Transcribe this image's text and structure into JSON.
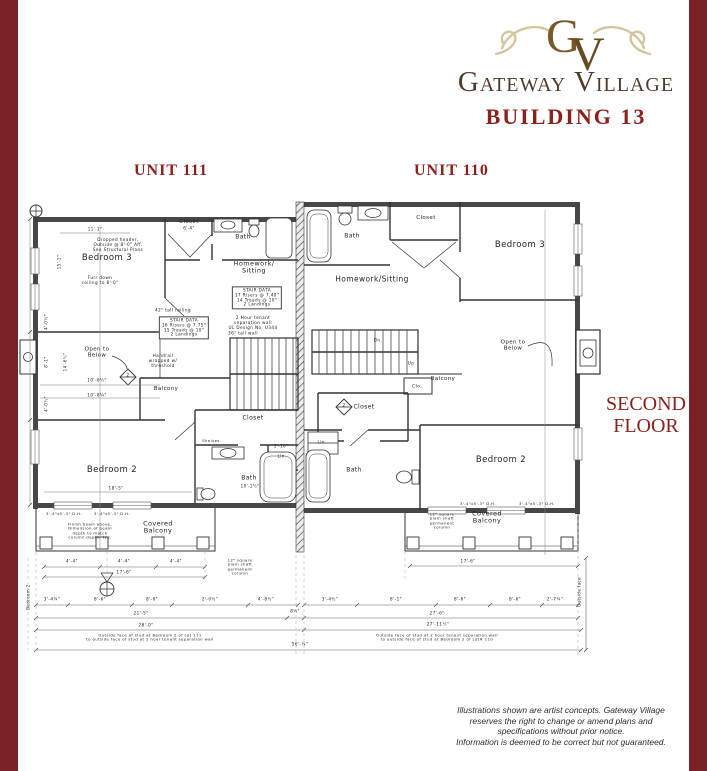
{
  "header": {
    "monogram": "GV",
    "brand": "Gateway Village",
    "building": "BUILDING 13"
  },
  "units": {
    "left": "UNIT 111",
    "right": "UNIT 110"
  },
  "floor": "SECOND FLOOR",
  "disclaimer": "Illustrations shown are artist concepts.  Gateway Village\nreserves the right to change or amend plans and\nspecifications without prior notice.\nInformation is deemed to be correct but not guaranteed.",
  "colors": {
    "maroon_border": "#7a2128",
    "brick_red": "#8d201d",
    "brand_brown": "#4e3b2b",
    "monogram_gold": "#77592c",
    "flourish_tan": "#d3c69c",
    "ink": "#333333"
  },
  "plan_labels": [
    {
      "n": "bedroom3-left-label",
      "t": "Bedroom 3",
      "x": 107,
      "y": 259,
      "fs": 8.5
    },
    {
      "n": "dropped-header-note",
      "t": "Dropped header,\nOutside @ 8'-0\" Aff.\nSee Structural Plans",
      "x": 118,
      "y": 245,
      "fs": 4.2
    },
    {
      "n": "furr-down-note",
      "t": "Furr down\nceiling to 8'-0\"",
      "x": 100,
      "y": 281,
      "fs": 4.2
    },
    {
      "n": "closet-left-top-label",
      "t": "Closet",
      "x": 189,
      "y": 222,
      "fs": 5.5
    },
    {
      "n": "closet-left-top-dim",
      "t": "6'-4\"",
      "x": 189,
      "y": 229,
      "fs": 4
    },
    {
      "n": "bath-left-top-label",
      "t": "Bath",
      "x": 243,
      "y": 238,
      "fs": 6
    },
    {
      "n": "homework-left-label",
      "t": "Homework/\nSitting",
      "x": 254,
      "y": 268,
      "fs": 6.5
    },
    {
      "n": "stair-data-left-1",
      "t": "STAIR DATA\n17 Risers @ 7.40\"\n14 Treads @ 10\"\n2 Landings",
      "x": 257,
      "y": 298,
      "fs": 4.2,
      "b": true
    },
    {
      "n": "tenant-wall-note-left",
      "t": "2 Hour tenant\nseparation wall\nUL Design No. U344",
      "x": 253,
      "y": 323,
      "fs": 4.2
    },
    {
      "n": "wall-36-note",
      "t": "36\" tall wall",
      "x": 243,
      "y": 334,
      "fs": 4.2
    },
    {
      "n": "stair-data-left-2",
      "t": "STAIR DATA\n16 Risers @ 7.75\"\n15 Treads @ 10\"\n2 Landings",
      "x": 184,
      "y": 328,
      "fs": 4.2,
      "b": true
    },
    {
      "n": "railing-42-note",
      "t": "42\" tall railing",
      "x": 173,
      "y": 311,
      "fs": 4.2
    },
    {
      "n": "handrail-note",
      "t": "Handrail\nwrapped w/\nthreshold",
      "x": 163,
      "y": 361,
      "fs": 4.2
    },
    {
      "n": "balcony-left-label",
      "t": "Balcony",
      "x": 166,
      "y": 389,
      "fs": 5.5
    },
    {
      "n": "open-below-left-label",
      "t": "Open to\nBelow",
      "x": 97,
      "y": 353,
      "fs": 5.5
    },
    {
      "n": "dim-10-6",
      "t": "10'-6½\"",
      "x": 97,
      "y": 381,
      "fs": 4.2
    },
    {
      "n": "dim-10-8",
      "t": "10'-8¼\"",
      "x": 97,
      "y": 396,
      "fs": 4.2
    },
    {
      "n": "bedroom2-left-label",
      "t": "Bedroom 2",
      "x": 112,
      "y": 471,
      "fs": 8.5
    },
    {
      "n": "dim-18-5",
      "t": "18'-5\"",
      "x": 116,
      "y": 489,
      "fs": 4.2
    },
    {
      "n": "closet-left-bot-label",
      "t": "Closet",
      "x": 253,
      "y": 419,
      "fs": 6
    },
    {
      "n": "shelves-note",
      "t": "Shelves",
      "x": 211,
      "y": 441,
      "fs": 3.8
    },
    {
      "n": "lin-left-label",
      "t": "Lin.",
      "x": 282,
      "y": 457,
      "fs": 4.2
    },
    {
      "n": "bath-left-bot-label",
      "t": "Bath",
      "x": 249,
      "y": 479,
      "fs": 6
    },
    {
      "n": "dim-10-1",
      "t": "10'-1½\"",
      "x": 250,
      "y": 487,
      "fs": 4
    },
    {
      "n": "dim-5-10",
      "t": "5'-10\"",
      "x": 281,
      "y": 447,
      "fs": 4
    },
    {
      "n": "window-dim-l1",
      "t": "3'-4\"x5'-3\" D.H.",
      "x": 64,
      "y": 514,
      "fs": 3.8
    },
    {
      "n": "window-dim-l2",
      "t": "3'-4\"x5'-3\" D.H.",
      "x": 112,
      "y": 514,
      "fs": 3.8
    },
    {
      "n": "finish-beam-note",
      "t": "Finish beam above.\nDimension of beam\ndepth to match\ncolumn depth, typ.",
      "x": 90,
      "y": 531,
      "fs": 3.8
    },
    {
      "n": "covered-balcony-left-label",
      "t": "Covered\nBalcony",
      "x": 158,
      "y": 528,
      "fs": 6.5
    },
    {
      "n": "column-note-left",
      "t": "12\" square\nplain shaft\npermanent\ncolumn",
      "x": 240,
      "y": 567,
      "fs": 3.8
    },
    {
      "n": "bath-right-top-label",
      "t": "Bath",
      "x": 352,
      "y": 237,
      "fs": 6
    },
    {
      "n": "closet-right-top-label",
      "t": "Closet",
      "x": 426,
      "y": 218,
      "fs": 5.5
    },
    {
      "n": "bedroom3-right-label",
      "t": "Bedroom 3",
      "x": 520,
      "y": 246,
      "fs": 8.5
    },
    {
      "n": "homework-right-label",
      "t": "Homework/Sitting",
      "x": 372,
      "y": 280,
      "fs": 7.5
    },
    {
      "n": "open-below-right-label",
      "t": "Open to\nBelow",
      "x": 513,
      "y": 346,
      "fs": 5.5
    },
    {
      "n": "dn-label",
      "t": "Dn.",
      "x": 378,
      "y": 341,
      "fs": 4.2
    },
    {
      "n": "up-label",
      "t": "Up",
      "x": 411,
      "y": 364,
      "fs": 4.2
    },
    {
      "n": "balcony-right-label",
      "t": "Balcony",
      "x": 443,
      "y": 379,
      "fs": 5.5
    },
    {
      "n": "clo-label",
      "t": "Clo.",
      "x": 417,
      "y": 387,
      "fs": 4.5
    },
    {
      "n": "closet-right-mid-label",
      "t": "Closet",
      "x": 364,
      "y": 408,
      "fs": 6
    },
    {
      "n": "lin-right-label",
      "t": "Lin.",
      "x": 322,
      "y": 443,
      "fs": 4.2
    },
    {
      "n": "bath-right-bot-label",
      "t": "Bath",
      "x": 354,
      "y": 471,
      "fs": 6
    },
    {
      "n": "bedroom2-right-label",
      "t": "Bedroom 2",
      "x": 501,
      "y": 461,
      "fs": 8.5
    },
    {
      "n": "window-dim-r1",
      "t": "3'-4\"x5'-3\" D.H.",
      "x": 478,
      "y": 504,
      "fs": 3.8
    },
    {
      "n": "window-dim-r2",
      "t": "3'-4\"x5'-3\" D.H.",
      "x": 537,
      "y": 504,
      "fs": 3.8
    },
    {
      "n": "covered-balcony-right-label",
      "t": "Covered\nBalcony",
      "x": 487,
      "y": 518,
      "fs": 6.5
    },
    {
      "n": "column-note-right",
      "t": "12\" square\nplain shaft\npermanent\ncolumn",
      "x": 442,
      "y": 521,
      "fs": 3.8
    },
    {
      "n": "dim-4-4-a",
      "t": "4'-4\"",
      "x": 72,
      "y": 562,
      "fs": 4.2
    },
    {
      "n": "dim-4-4-b",
      "t": "4'-4\"",
      "x": 124,
      "y": 562,
      "fs": 4.2
    },
    {
      "n": "dim-4-4-c",
      "t": "4'-4\"",
      "x": 176,
      "y": 562,
      "fs": 4.2
    },
    {
      "n": "dim-17-6-left",
      "t": "17'-6\"",
      "x": 124,
      "y": 573,
      "fs": 4.2
    },
    {
      "n": "dim-17-6-right",
      "t": "17'-6\"",
      "x": 468,
      "y": 562,
      "fs": 4.2
    },
    {
      "n": "dim-3-4q",
      "t": "3'-4¼\"",
      "x": 52,
      "y": 600,
      "fs": 4.2
    },
    {
      "n": "dim-8-6-a",
      "t": "8'-6\"",
      "x": 100,
      "y": 600,
      "fs": 4.2
    },
    {
      "n": "dim-8-6-b",
      "t": "8'-6\"",
      "x": 152,
      "y": 600,
      "fs": 4.2
    },
    {
      "n": "dim-2-0",
      "t": "2'-0½\"",
      "x": 210,
      "y": 600,
      "fs": 4.2
    },
    {
      "n": "dim-4-8",
      "t": "4'-8½\"",
      "x": 266,
      "y": 600,
      "fs": 4.2
    },
    {
      "n": "dim-3-4h",
      "t": "3'-4½\"",
      "x": 330,
      "y": 600,
      "fs": 4.2
    },
    {
      "n": "dim-8-1r",
      "t": "8'-1\"",
      "x": 396,
      "y": 600,
      "fs": 4.2
    },
    {
      "n": "dim-8-6-c",
      "t": "8'-6\"",
      "x": 460,
      "y": 600,
      "fs": 4.2
    },
    {
      "n": "dim-8-6-d",
      "t": "8'-6\"",
      "x": 515,
      "y": 600,
      "fs": 4.2
    },
    {
      "n": "dim-2-7",
      "t": "2'-7¼\"",
      "x": 555,
      "y": 600,
      "fs": 4.2
    },
    {
      "n": "dim-21-5",
      "t": "21'-5\"",
      "x": 141,
      "y": 614,
      "fs": 4.2
    },
    {
      "n": "dim-8h",
      "t": "8½\"",
      "x": 295,
      "y": 612,
      "fs": 4
    },
    {
      "n": "dim-27-6",
      "t": "27'-6\"",
      "x": 437,
      "y": 614,
      "fs": 4.2
    },
    {
      "n": "dim-28-0",
      "t": "28'-0\"",
      "x": 146,
      "y": 626,
      "fs": 4.2
    },
    {
      "n": "dim-27-11",
      "t": "27'-11½\"",
      "x": 438,
      "y": 625,
      "fs": 4.2
    },
    {
      "n": "stud-note-left",
      "t": "Outside face of stud at Bedroom 2 of Lot 111\nto outside face of stud at 2 hour tenant separation wall",
      "x": 150,
      "y": 638,
      "fs": 3.8
    },
    {
      "n": "stud-note-right",
      "t": "Outside face of stud at 2 hour tenant separation wall\nto outside face of stud at Bedroom 2 of Lot# 110",
      "x": 437,
      "y": 638,
      "fs": 3.8
    },
    {
      "n": "dim-56",
      "t": "56'-¼\"",
      "x": 300,
      "y": 645,
      "fs": 4.2
    },
    {
      "n": "outside-face-label",
      "t": "Outside face",
      "x": 580,
      "y": 592,
      "fs": 4,
      "r": -90
    },
    {
      "n": "bedroom2-vert-label",
      "t": "Bedroom 2",
      "x": 29,
      "y": 597,
      "fs": 4,
      "r": -90
    },
    {
      "n": "dim-15-2",
      "t": "15'-2\"",
      "x": 60,
      "y": 262,
      "fs": 4,
      "r": -90
    },
    {
      "n": "dim-4-0-a",
      "t": "4'-0½\"",
      "x": 47,
      "y": 322,
      "fs": 4,
      "r": -90
    },
    {
      "n": "dim-8-1l",
      "t": "8'-1\"",
      "x": 47,
      "y": 362,
      "fs": 4,
      "r": -90
    },
    {
      "n": "dim-4-0-b",
      "t": "4'-0½\"",
      "x": 47,
      "y": 404,
      "fs": 4,
      "r": -90
    },
    {
      "n": "dim-14-6",
      "t": "14'-6½\"",
      "x": 66,
      "y": 362,
      "fs": 4,
      "r": -90
    },
    {
      "n": "dim-11-1",
      "t": "11'-1\"",
      "x": 95,
      "y": 230,
      "fs": 4
    },
    {
      "n": "detail-marker-2-left",
      "t": "2",
      "x": 128,
      "y": 376,
      "fs": 4.5
    },
    {
      "n": "detail-marker-2-right",
      "t": "2",
      "x": 344,
      "y": 406,
      "fs": 4.5
    }
  ]
}
